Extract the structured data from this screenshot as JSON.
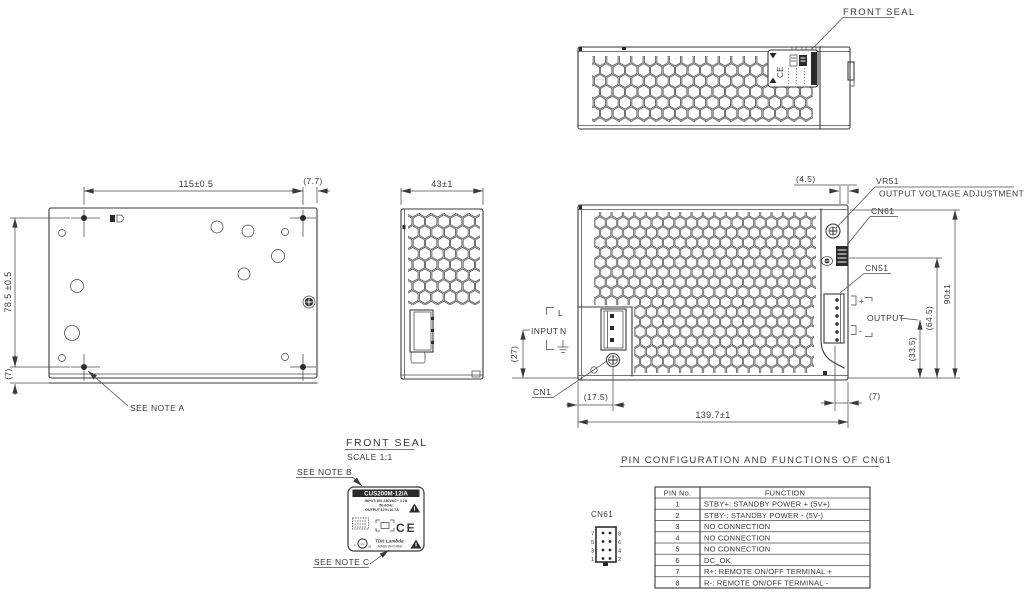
{
  "colors": {
    "line": "#3a3a3a",
    "bg": "#ffffff"
  },
  "top_view": {
    "front_seal": "FRONT SEAL"
  },
  "bottom_view": {
    "dim_width": "115±0.5",
    "dim_offset": "(7.7)",
    "dim_height": "78.5 ±0.5",
    "dim_flange": "(7)",
    "note_a": "SEE NOTE A"
  },
  "side_view": {
    "dim_width": "43±1"
  },
  "main_view": {
    "dim_offset_top": "(4.5)",
    "vr51": "VR51",
    "vr51_desc": "OUTPUT VOLTAGE ADJUSTMENT",
    "cn61": "CN61",
    "cn51": "CN51",
    "cn1": "CN1",
    "input_l": "L",
    "input_label": "INPUT",
    "input_n": "N",
    "dim_input": "(27)",
    "dim_cn1": "(17.5)",
    "dim_length": "139.7±1",
    "dim_edge": "(7)",
    "output_plus": "+",
    "output_label": "OUTPUT",
    "output_minus": "-",
    "dim_height": "90±1",
    "dim_cn61": "(64.5)",
    "dim_output": "(33.5)"
  },
  "seal": {
    "title": "FRONT SEAL",
    "scale": "SCALE 1:1",
    "note_b": "SEE NOTE B",
    "note_c": "SEE NOTE C",
    "label": {
      "model": "CUS200M-12/A",
      "input": "INPUT:100-240VAC~ 3.2A",
      "freq": "50-60Hz",
      "output": "OUTPUT:12V=16.7A",
      "ce": "CE",
      "ul": "UL",
      "ul_c": "c",
      "ul_us": "us",
      "brand": "TDK·Lambda",
      "origin": "MADE IN CHINA"
    }
  },
  "pin_table": {
    "title": "PIN CONFIGURATION AND FUNCTIONS OF CN61",
    "connector": "CN61",
    "col_pin": "PIN No.",
    "col_function": "FUNCTION",
    "rows": [
      {
        "pin": "1",
        "fn": "STBY+: STANDBY POWER + (5V+)"
      },
      {
        "pin": "2",
        "fn": "STBY-: STANDBY POWER - (5V-)"
      },
      {
        "pin": "3",
        "fn": "NO CONNECTION"
      },
      {
        "pin": "4",
        "fn": "NO CONNECTION"
      },
      {
        "pin": "5",
        "fn": "NO CONNECTION"
      },
      {
        "pin": "6",
        "fn": "DC_OK"
      },
      {
        "pin": "7",
        "fn": "R+: REMOTE ON/OFF TERMINAL +"
      },
      {
        "pin": "8",
        "fn": "R-: REMOTE ON/OFF TERMINAL -"
      }
    ],
    "pins_left": [
      "7",
      "5",
      "3",
      "1"
    ],
    "pins_right": [
      "8",
      "6",
      "4",
      "2"
    ]
  }
}
